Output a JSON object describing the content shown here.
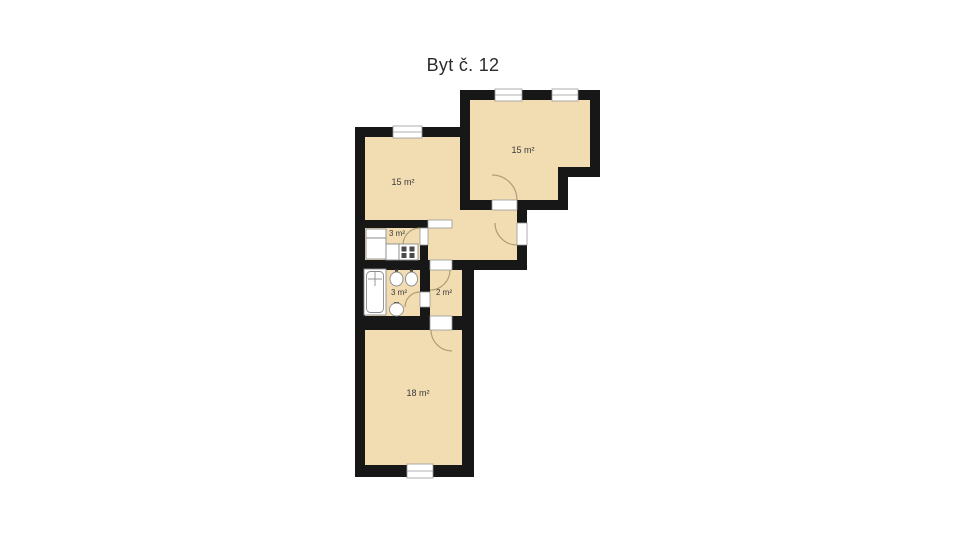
{
  "title": "Byt č. 12",
  "colors": {
    "background": "#ffffff",
    "floor": "#f2dcb2",
    "wall": "#171717",
    "opening": "#ffffff",
    "frame": "#999999",
    "fixture": "#ffffff",
    "fixture_border": "#8c8c8c",
    "burner": "#4a4a4a",
    "door_arc": "#a5936f",
    "label": "#3a3a3a",
    "title_color": "#2b2b2b"
  },
  "rooms": [
    {
      "id": "room-top-left",
      "label": "15 m²"
    },
    {
      "id": "room-top-right",
      "label": "15 m²"
    },
    {
      "id": "kitchen",
      "label": "3 m²",
      "fixtures": [
        "fridge",
        "counter",
        "stove"
      ]
    },
    {
      "id": "bathroom",
      "label": "3 m²",
      "fixtures": [
        "bathtub",
        "sink",
        "sink",
        "toilet"
      ]
    },
    {
      "id": "hallway",
      "label": "2 m²"
    },
    {
      "id": "room-bottom",
      "label": "18 m²"
    }
  ]
}
